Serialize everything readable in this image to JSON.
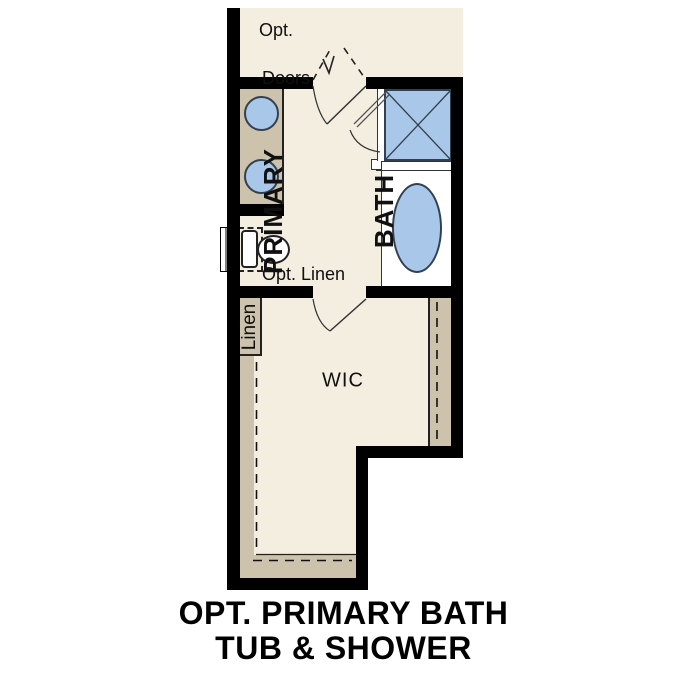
{
  "plan": {
    "labels": {
      "opt_doors_line1": "Opt.",
      "opt_doors_line2": "Doors",
      "primary_bath_line1": "PRIMARY",
      "primary_bath_line2": "BATH",
      "opt_linen": "Opt. Linen",
      "linen": "Linen",
      "wic": "WIC"
    }
  },
  "title": {
    "line1": "OPT. PRIMARY BATH",
    "line2": "TUB & SHOWER"
  },
  "colors": {
    "floor": "#f4eee1",
    "cabinet": "#cdc2ac",
    "fixture": "#a9c8e9",
    "wall": "#000000",
    "background": "#ffffff"
  }
}
